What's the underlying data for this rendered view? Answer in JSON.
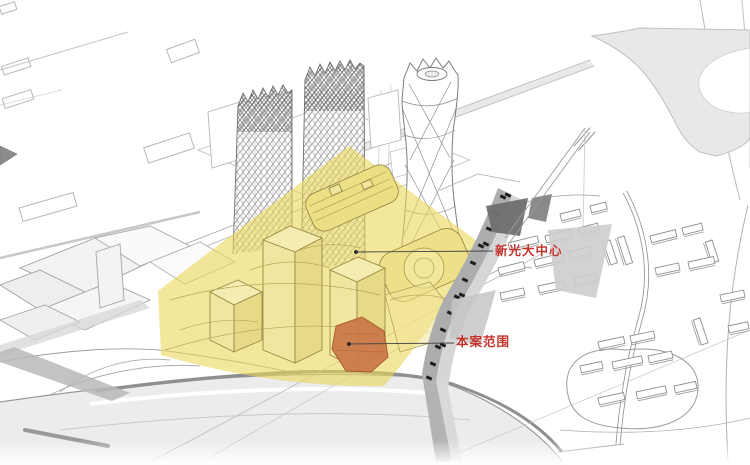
{
  "annotations": {
    "center_tower": {
      "label": "新光大中心"
    },
    "project_scope": {
      "label": "本案范围"
    }
  },
  "colors": {
    "annotation_red": "#C2342C",
    "site_highlight_yellow": "#F2E68F",
    "project_parcel_orange": "#CC7A4A",
    "linework_gray": "#9A9A9A",
    "road_fill_gray": "#ECECEC"
  },
  "icons": {
    "anchor_dot": "●",
    "cursor_arrow": "➤"
  }
}
